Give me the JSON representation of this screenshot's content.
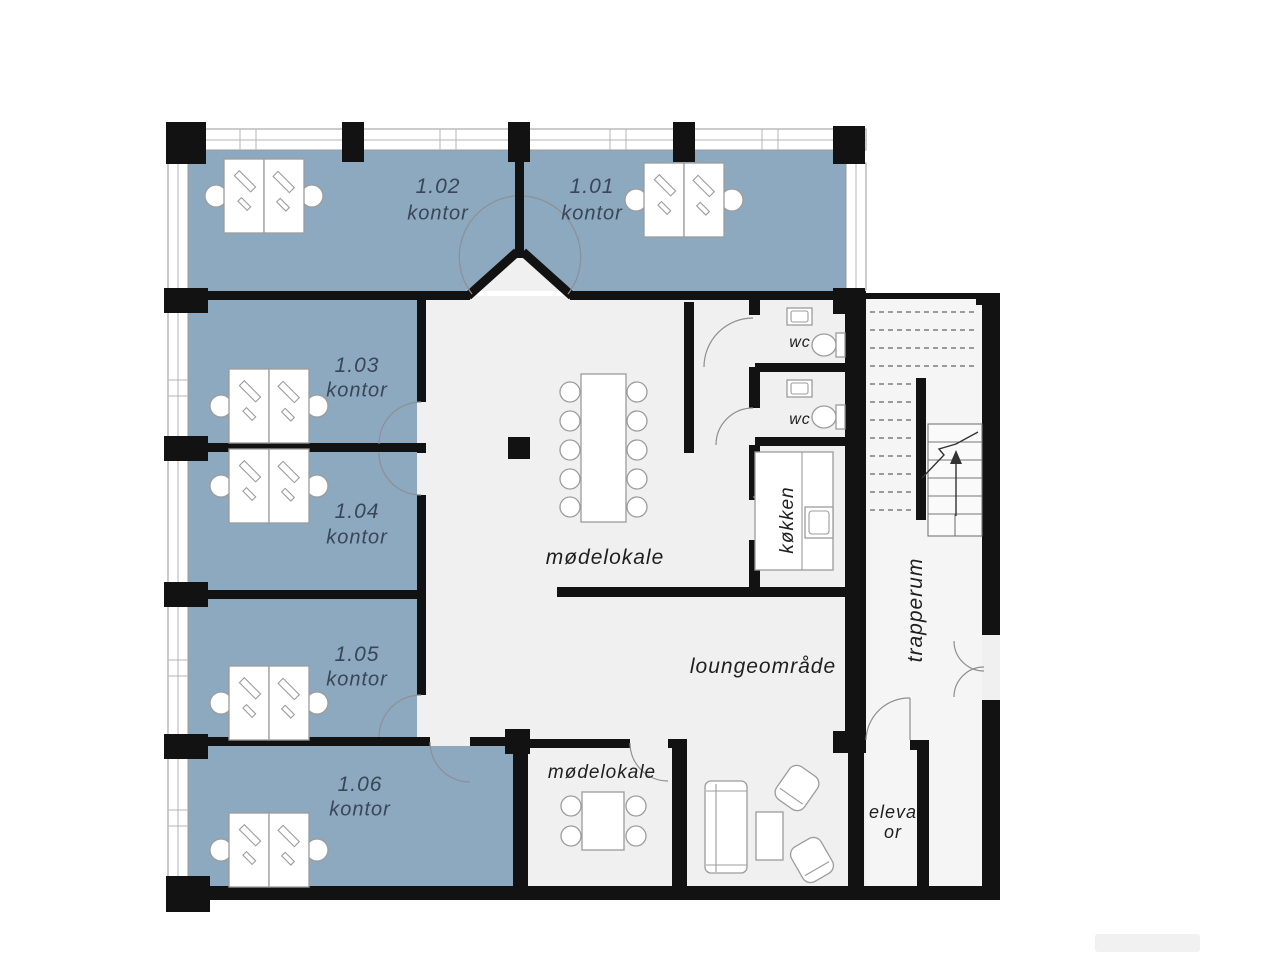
{
  "rooms": {
    "r102": {
      "number": "1.02",
      "type": "kontor"
    },
    "r101": {
      "number": "1.01",
      "type": "kontor"
    },
    "r103": {
      "number": "1.03",
      "type": "kontor"
    },
    "r104": {
      "number": "1.04",
      "type": "kontor"
    },
    "r105": {
      "number": "1.05",
      "type": "kontor"
    },
    "r106": {
      "number": "1.06",
      "type": "kontor"
    },
    "meeting_main": {
      "label": "mødelokale"
    },
    "meeting_small": {
      "label": "mødelokale"
    },
    "lounge": {
      "label": "loungeområde"
    },
    "wc_upper": {
      "label": "wc"
    },
    "wc_lower": {
      "label": "wc"
    },
    "kitchen": {
      "label": "køkken"
    },
    "stairwell": {
      "label": "trapperum"
    },
    "elevator": {
      "label_line1": "eleva",
      "label_line2": "or"
    }
  },
  "colors": {
    "office-fill": "#8ca9c0",
    "floor": "#f0f0f0",
    "stair-floor": "#f5f5f5",
    "wall": "#121212",
    "room-label": "#3a4656",
    "label": "#1f1f1f"
  }
}
